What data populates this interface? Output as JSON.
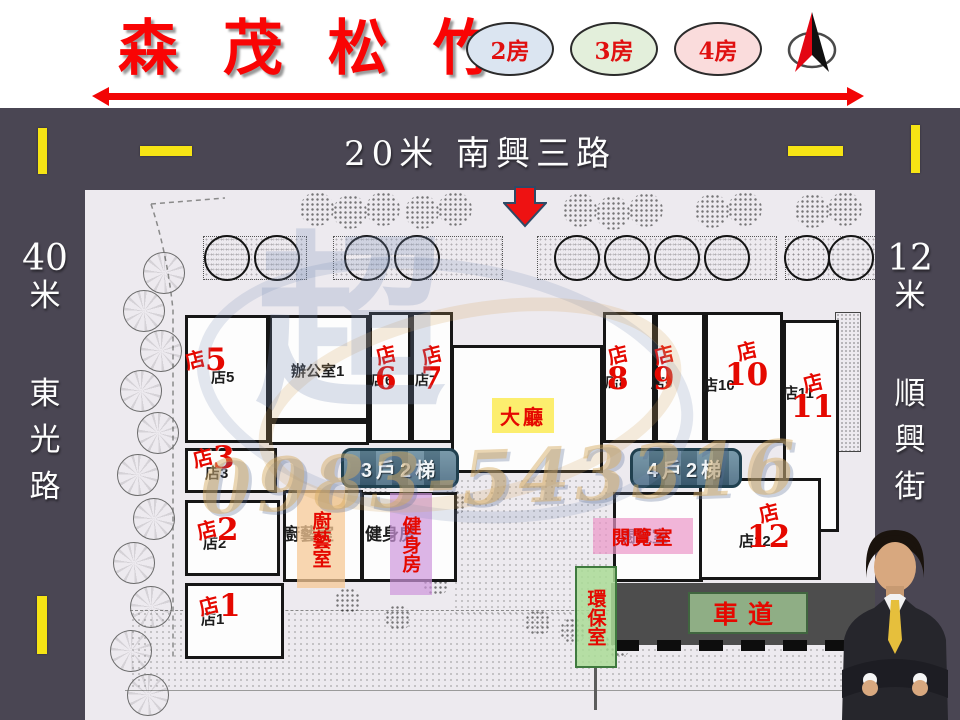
{
  "title": "森 茂 松 竹",
  "legend": [
    {
      "label": "2房",
      "fill": "#dbe5f1"
    },
    {
      "label": "3房",
      "fill": "#e3efdb"
    },
    {
      "label": "4房",
      "fill": "#fadcdc"
    }
  ],
  "compass": "north-arrow",
  "roads": {
    "top": "20米  南興三路",
    "left_width": "40",
    "left_unit": "米",
    "left_name_chars": [
      "東",
      "光",
      "路"
    ],
    "right_width": "12",
    "right_unit": "米",
    "right_name_chars": [
      "順",
      "興",
      "街"
    ]
  },
  "plan": {
    "office": "辦公室1",
    "lobby": "大廳",
    "stair_left": "3戶2梯",
    "stair_right": "4戶2梯",
    "kitchen": "廚藝室",
    "gym": "健身房",
    "reading": "閱覽室",
    "eco": "環保室",
    "driveway": "車道",
    "shops": [
      {
        "black": "店5",
        "cn": "店",
        "num": "5"
      },
      {
        "black": "店6",
        "cn": "店",
        "num": "6"
      },
      {
        "black": "店7",
        "cn": "店",
        "num": "7"
      },
      {
        "black": "店8",
        "cn": "店",
        "num": "8"
      },
      {
        "black": "店9",
        "cn": "店",
        "num": "9"
      },
      {
        "black": "店10",
        "cn": "店",
        "num": "10"
      },
      {
        "black": "店11",
        "cn": "店",
        "num": "11"
      },
      {
        "black": "店12",
        "cn": "店",
        "num": "12"
      },
      {
        "black": "店3",
        "cn": "店",
        "num": "3"
      },
      {
        "black": "店2",
        "cn": "店",
        "num": "2"
      },
      {
        "black": "店1",
        "cn": "店",
        "num": "1"
      }
    ]
  },
  "watermark": {
    "logo": "超",
    "phone": "0983-543316"
  },
  "colors": {
    "band_dark": "#4a4653",
    "road_yellow": "#f6e414",
    "accent_red": "#e50800",
    "lobby_bg": "#fcee6e",
    "kitchen_bg": "#f6c896",
    "gym_bg": "#cd96dc",
    "reading_bg": "#eb96c8",
    "eco_bg": "#aadc96",
    "driveway_badge_bg": "#8fae85",
    "stair_badge_bg": "#4a7085"
  }
}
